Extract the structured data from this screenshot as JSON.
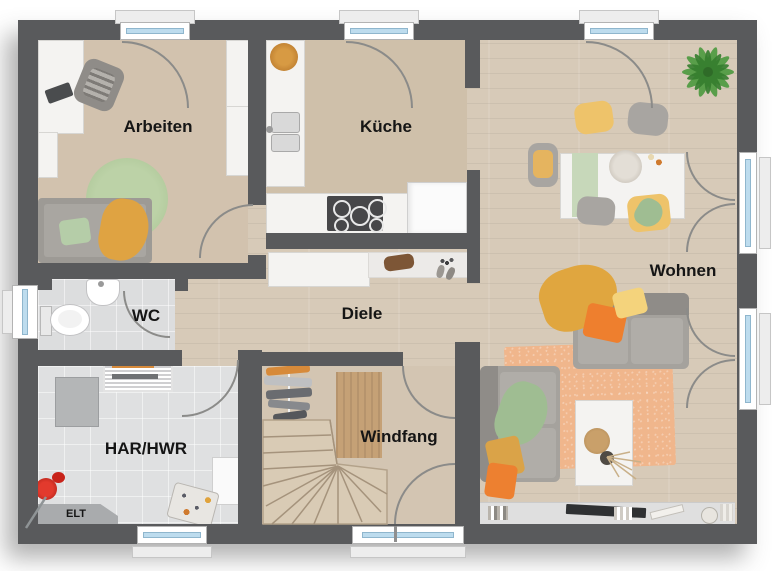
{
  "meta": {
    "type": "floor-plan",
    "view": "top-down",
    "language": "de"
  },
  "rooms": [
    {
      "id": "arbeiten",
      "label": "Arbeiten"
    },
    {
      "id": "kueche",
      "label": "Küche"
    },
    {
      "id": "wohnen",
      "label": "Wohnen"
    },
    {
      "id": "wc",
      "label": "WC"
    },
    {
      "id": "diele",
      "label": "Diele"
    },
    {
      "id": "har_hwr",
      "label": "HAR/HWR"
    },
    {
      "id": "windfang",
      "label": "Windfang"
    },
    {
      "id": "elt",
      "label": "ELT"
    }
  ],
  "colors": {
    "wall": "#595a5c",
    "wood_floor": "#d7cab8",
    "tile_floor": "#dcddde",
    "window_glass": "#bddcee",
    "accent_orange": "#ed8030",
    "accent_mustard": "#dfa342",
    "accent_yellow": "#f2d07d",
    "accent_green": "#a9c49a",
    "rug_orange": "#f0b68c",
    "rug_green": "#b3cb9e",
    "plant_green": "#4c9a3f",
    "sofa_grey": "#a5a29d",
    "vacuum_red": "#cc2422"
  },
  "openings": {
    "top_windows": 3,
    "left_windows": 1,
    "bottom_windows": 1,
    "french_doors_right": 2,
    "entrance_door": 1,
    "interior_door_arcs": 5
  },
  "furniture": {
    "arbeiten": [
      "desk",
      "monitor",
      "office-chair",
      "tall-cabinet",
      "wardrobe",
      "round-rug",
      "daybed",
      "pillow",
      "throw-blanket"
    ],
    "kueche": [
      "fruit-bowl",
      "kitchen-counter",
      "double-sink",
      "cooktop",
      "fridge"
    ],
    "wc": [
      "washbasin",
      "toilet"
    ],
    "diele": [
      "sideboard",
      "handbag",
      "keys",
      "shoes"
    ],
    "har_hwr": [
      "drying-rack",
      "freezer",
      "washing-machine",
      "laundry-basket",
      "vacuum-cleaner"
    ],
    "windfang": [
      "coat-rack",
      "doormat",
      "winder-stairs"
    ],
    "wohnen": [
      "potted-plant",
      "dining-table",
      "table-runner",
      "bouquet",
      "fruit-platter",
      "dining-chair",
      "sofa",
      "throw-blanket",
      "cushion",
      "area-rug",
      "coffee-table",
      "decor-tray",
      "dried-plant",
      "tv-lowboard",
      "tv",
      "books",
      "candle"
    ]
  }
}
